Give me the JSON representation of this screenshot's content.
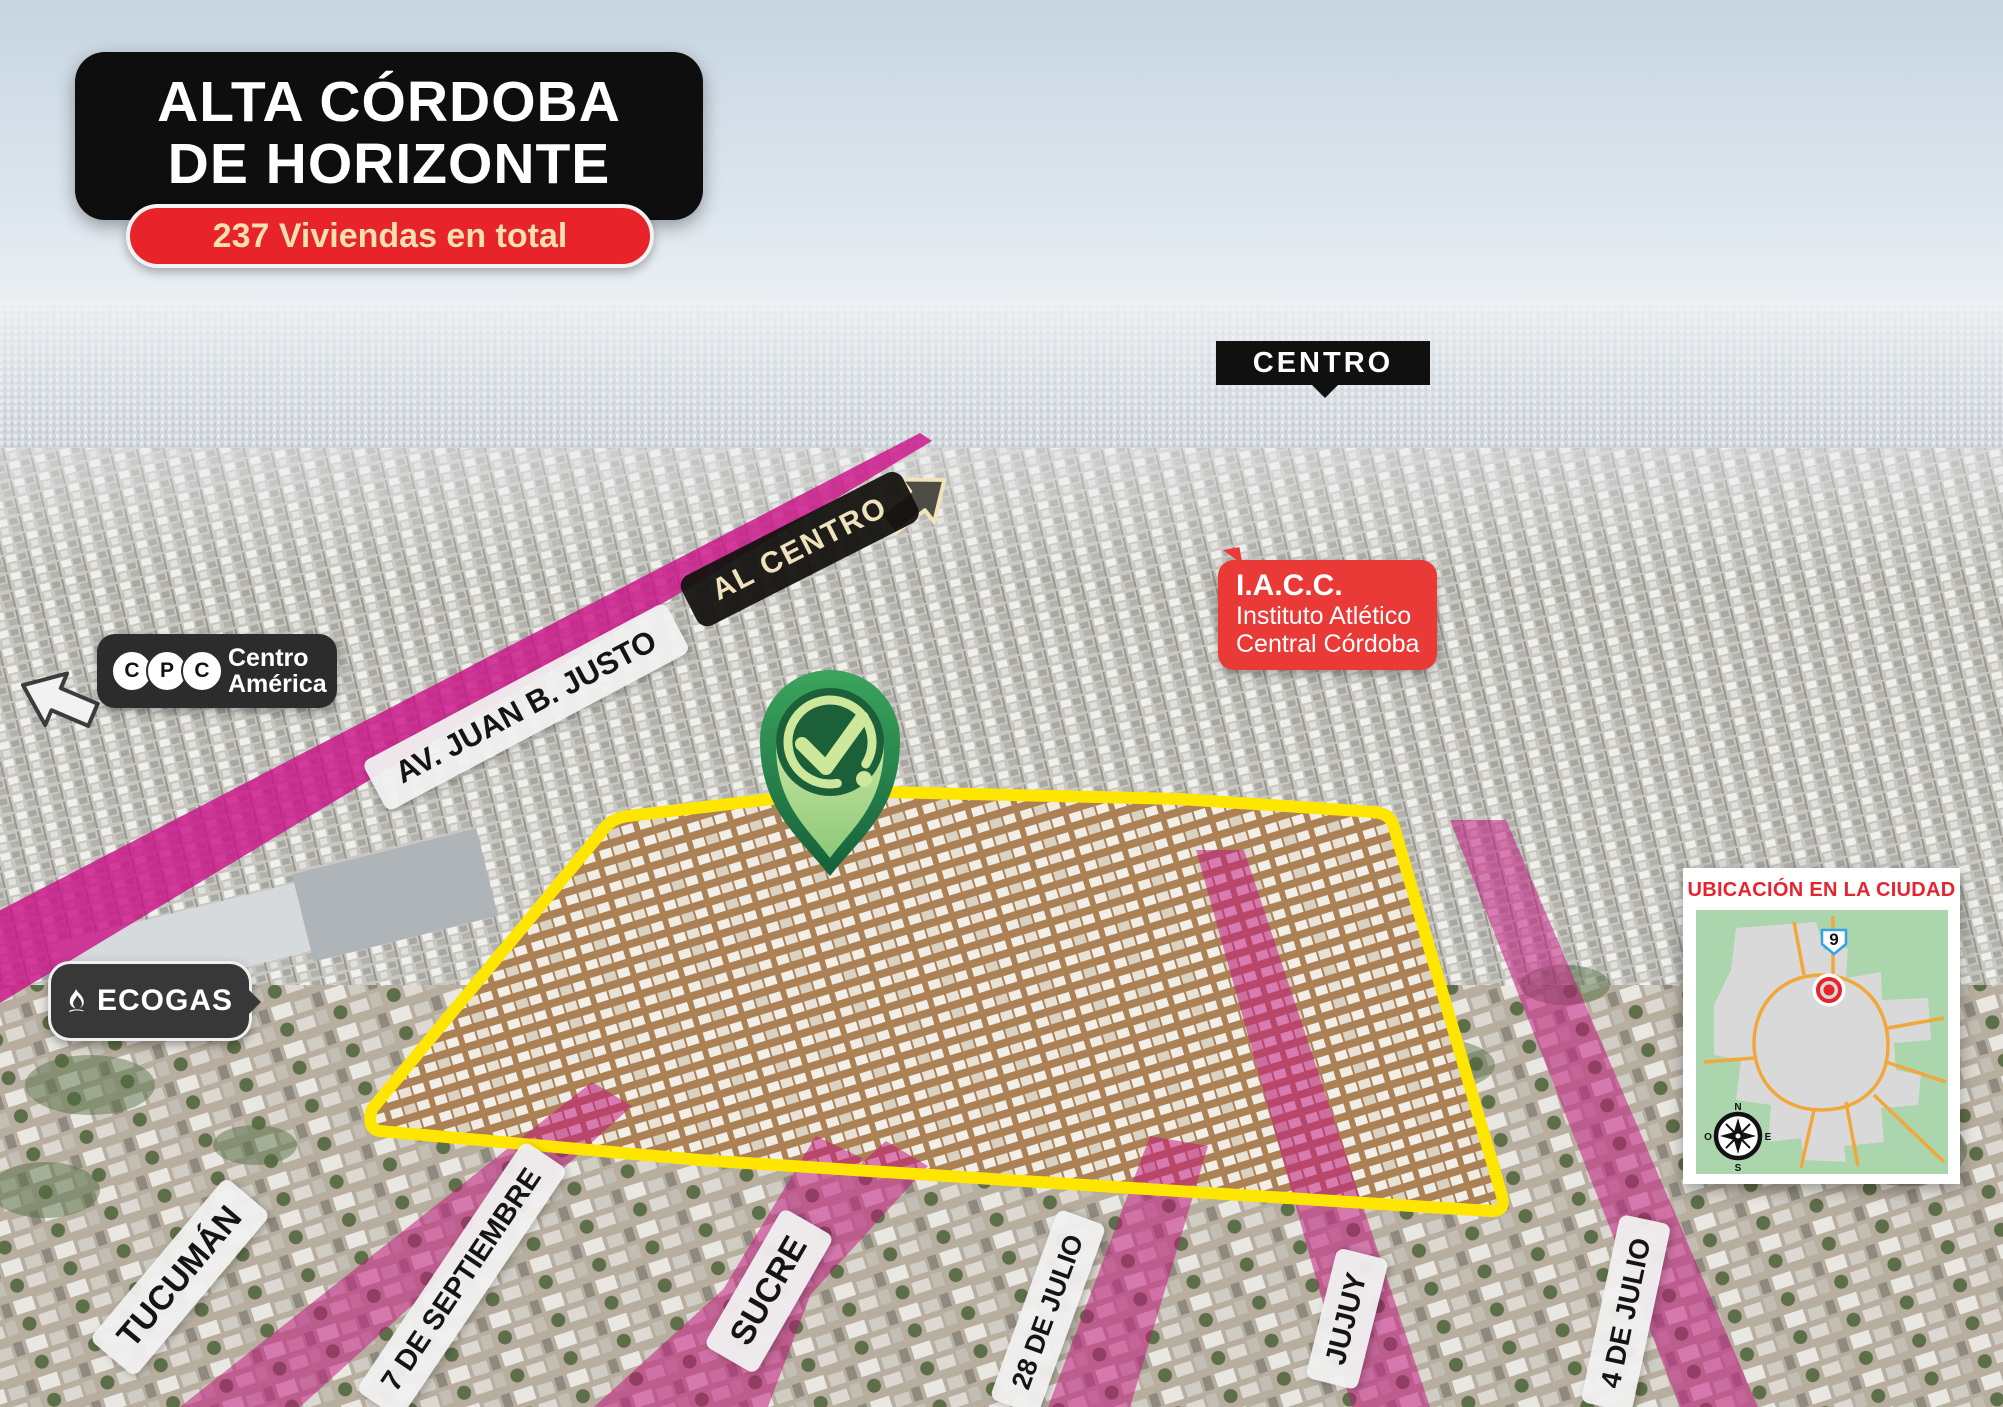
{
  "colors": {
    "accent_yellow": "#FFE600",
    "road_magenta": "#C4137E",
    "brand_red": "#E8232A",
    "badge_dark": "#101010",
    "pin_green_dark": "#1B6038",
    "pin_green_light": "#CDE79B",
    "minimap_green": "#ABD5AC",
    "minimap_road_orange": "#F2A73B"
  },
  "header": {
    "title_line1": "ALTA CÓRDOBA",
    "title_line2": "DE HORIZONTE",
    "badge": "237 Viviendas en total"
  },
  "annotations": {
    "centro": "CENTRO",
    "al_centro": "AL CENTRO",
    "avenue": "AV. JUAN B. JUSTO",
    "cpc": {
      "logo_letters": [
        "C",
        "P",
        "C"
      ],
      "line1": "Centro",
      "line2": "América"
    },
    "iacc": {
      "title": "I.A.C.C.",
      "line1": "Instituto Atlético",
      "line2": "Central Córdoba"
    },
    "ecogas": "ECOGAS"
  },
  "streets": [
    {
      "label": "TUCUMÁN"
    },
    {
      "label": "7 DE SEPTIEMBRE"
    },
    {
      "label": "SUCRE"
    },
    {
      "label": "28 DE JULIO"
    },
    {
      "label": "JUJUY"
    },
    {
      "label": "4 DE JULIO"
    }
  ],
  "minimap": {
    "title": "UBICACIÓN EN LA CIUDAD",
    "route_shield": "9",
    "compass": {
      "n": "N",
      "e": "E",
      "s": "S",
      "w": "O"
    }
  }
}
